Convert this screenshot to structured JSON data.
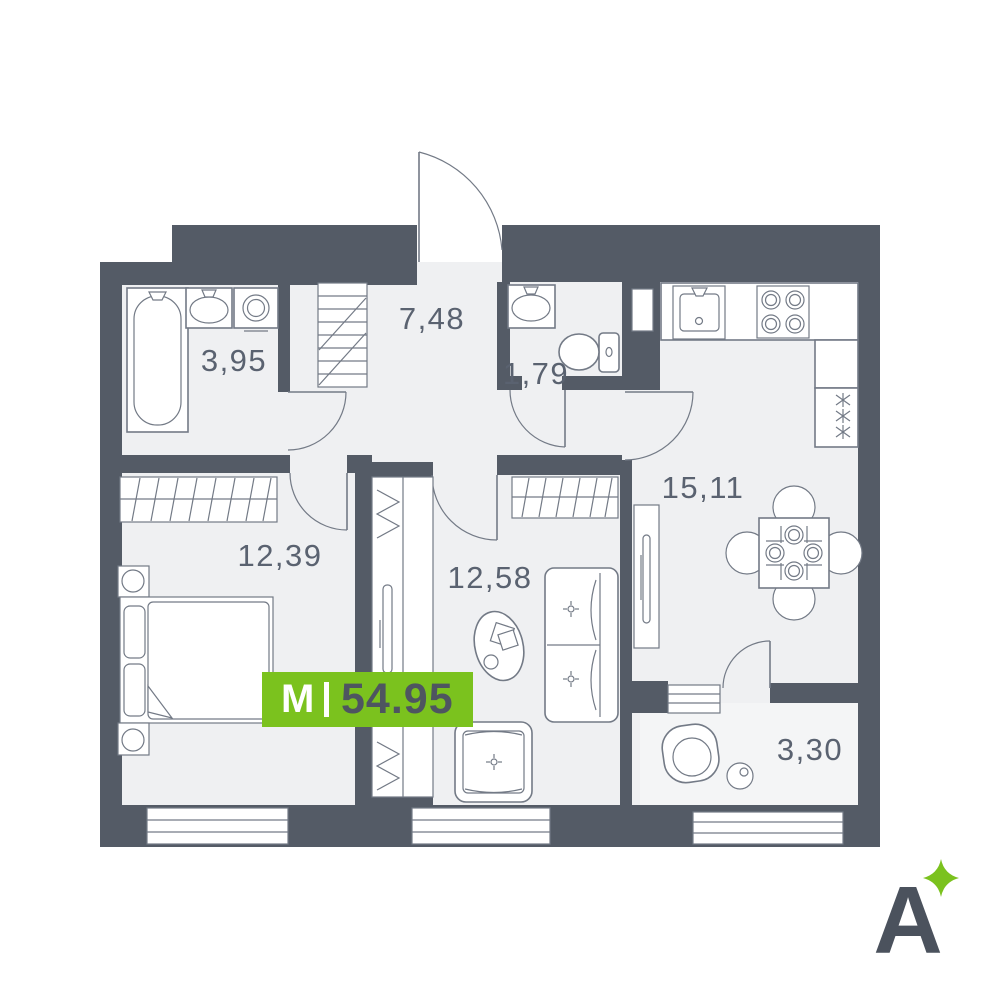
{
  "plan": {
    "badge": {
      "label": "M",
      "separator": "|",
      "total_area": "54.95"
    },
    "rooms": [
      {
        "name": "bathroom",
        "area": "3,95"
      },
      {
        "name": "hallway",
        "area": "7,48"
      },
      {
        "name": "toilet",
        "area": "1,79"
      },
      {
        "name": "bedroom",
        "area": "12,39"
      },
      {
        "name": "living-room",
        "area": "12,58"
      },
      {
        "name": "kitchen",
        "area": "15,11"
      },
      {
        "name": "balcony",
        "area": "3,30"
      }
    ],
    "logo": {
      "letter": "A",
      "sparkle": "four-point-star"
    },
    "colors": {
      "wall": "#545B66",
      "floor": "#EFF0F2",
      "balcony_floor": "#F4F5F6",
      "accent_green": "#7BC21E",
      "number_dark": "#4E5560",
      "label_gray": "#5A6270",
      "furniture_line": "#737A86"
    }
  }
}
